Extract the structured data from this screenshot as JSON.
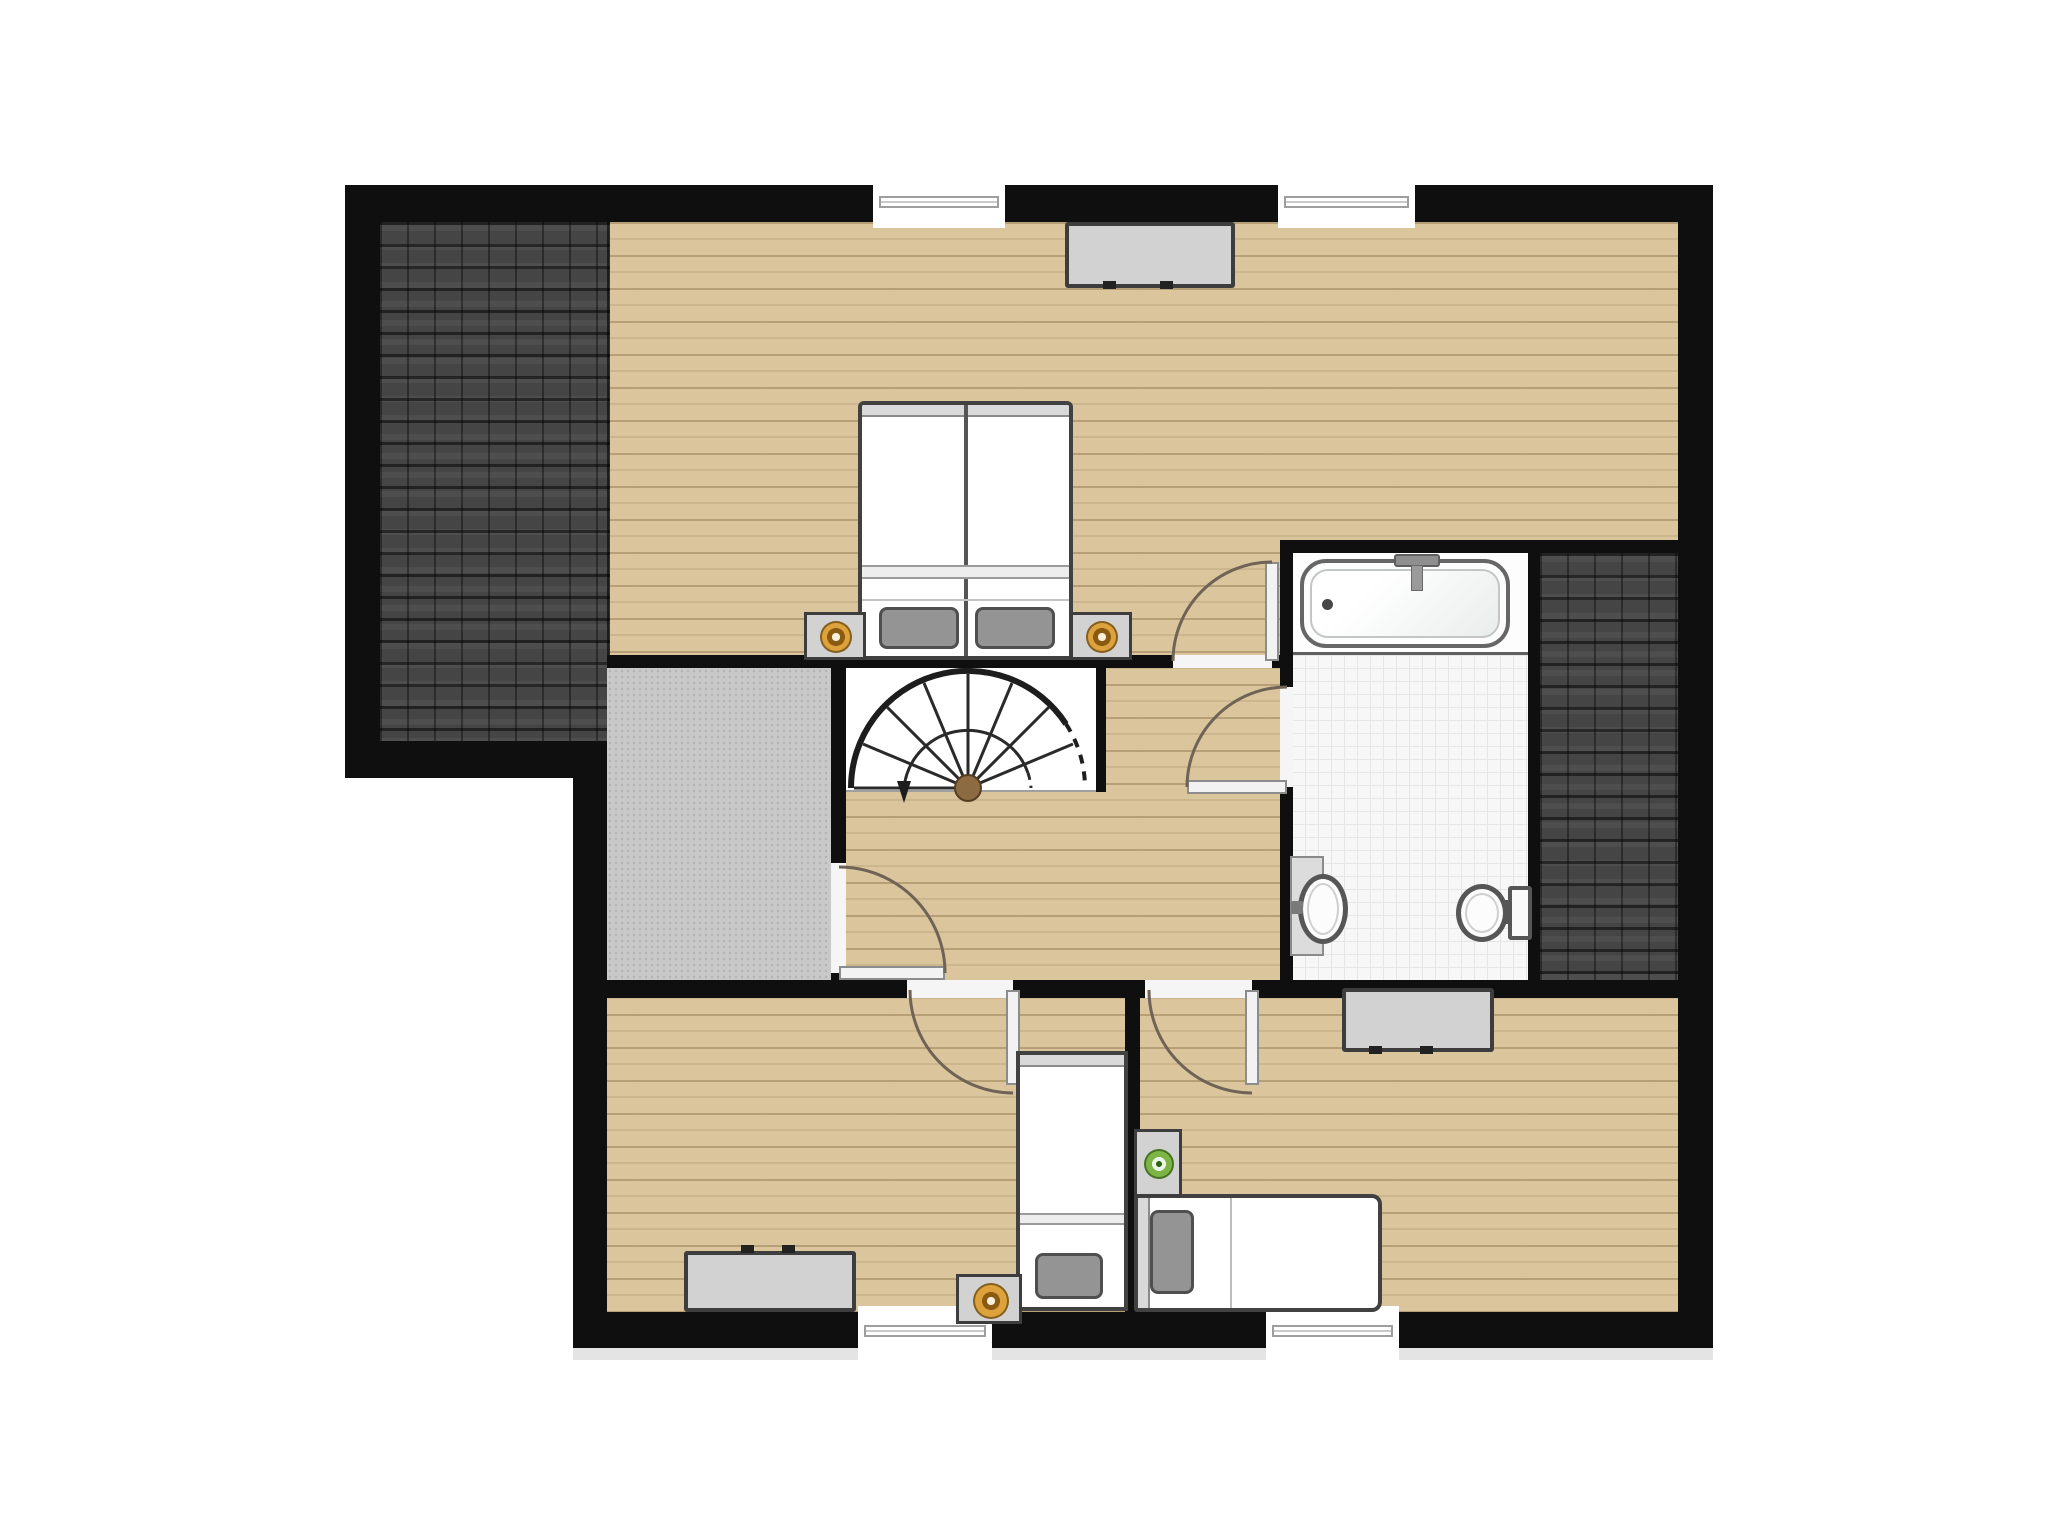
{
  "meta": {
    "kind": "floor-plan",
    "level": "upper-floor",
    "visible_text": "none"
  },
  "colors": {
    "wall": "#0f0f0f",
    "wood": "#dac59d",
    "roof": "#454545",
    "landing": "#c9c9c9",
    "tile": "#f7f7f7",
    "tileLine": "#e6e6e6",
    "furnFill": "#d2d2d2",
    "furnLine": "#3d3d3d",
    "pillow": "#949494",
    "lampOrange": "#dda23c",
    "lampOrangeRing": "#8a5a10",
    "lampOrangeCtr": "#f7efdb",
    "lampGreen": "#7cb544",
    "doorLeaf": "#f2f2f2",
    "doorArc": "#6f6355",
    "stairLine": "#1d1d1d",
    "stairHub": "#8d6b42",
    "shadow": "#e4e4e4"
  },
  "rooms": {
    "master": {
      "id": "master-bedroom",
      "floor": "wood"
    },
    "bedroom2": {
      "id": "bedroom-left",
      "floor": "wood"
    },
    "bedroom3": {
      "id": "bedroom-right",
      "floor": "wood"
    },
    "bathroom": {
      "id": "bathroom",
      "floor": "tile"
    },
    "hallway": {
      "id": "hallway-landing",
      "floor": "wood"
    },
    "storage": {
      "id": "storage-room",
      "floor": "concrete"
    },
    "stairs": {
      "id": "stairwell",
      "floor": "white"
    },
    "roofL": {
      "id": "roof-left",
      "floor": "roof-tiles"
    },
    "roofR": {
      "id": "roof-right",
      "floor": "roof-tiles"
    }
  },
  "fixtures": [
    "double-bed",
    "nightstand-lamp-orange",
    "nightstand-lamp-orange",
    "dresser",
    "spiral-staircase",
    "bathtub",
    "washbasin",
    "toilet",
    "single-bed",
    "nightstand-lamp-orange",
    "dresser",
    "single-bed",
    "nightstand-lamp-green",
    "dresser"
  ],
  "doors": [
    "master-bedroom-door",
    "bathroom-door",
    "storage-room-door",
    "bedroom-left-door",
    "bedroom-right-door"
  ],
  "windows": [
    "window-top-left",
    "window-top-right",
    "window-bottom-left",
    "window-bottom-right"
  ]
}
